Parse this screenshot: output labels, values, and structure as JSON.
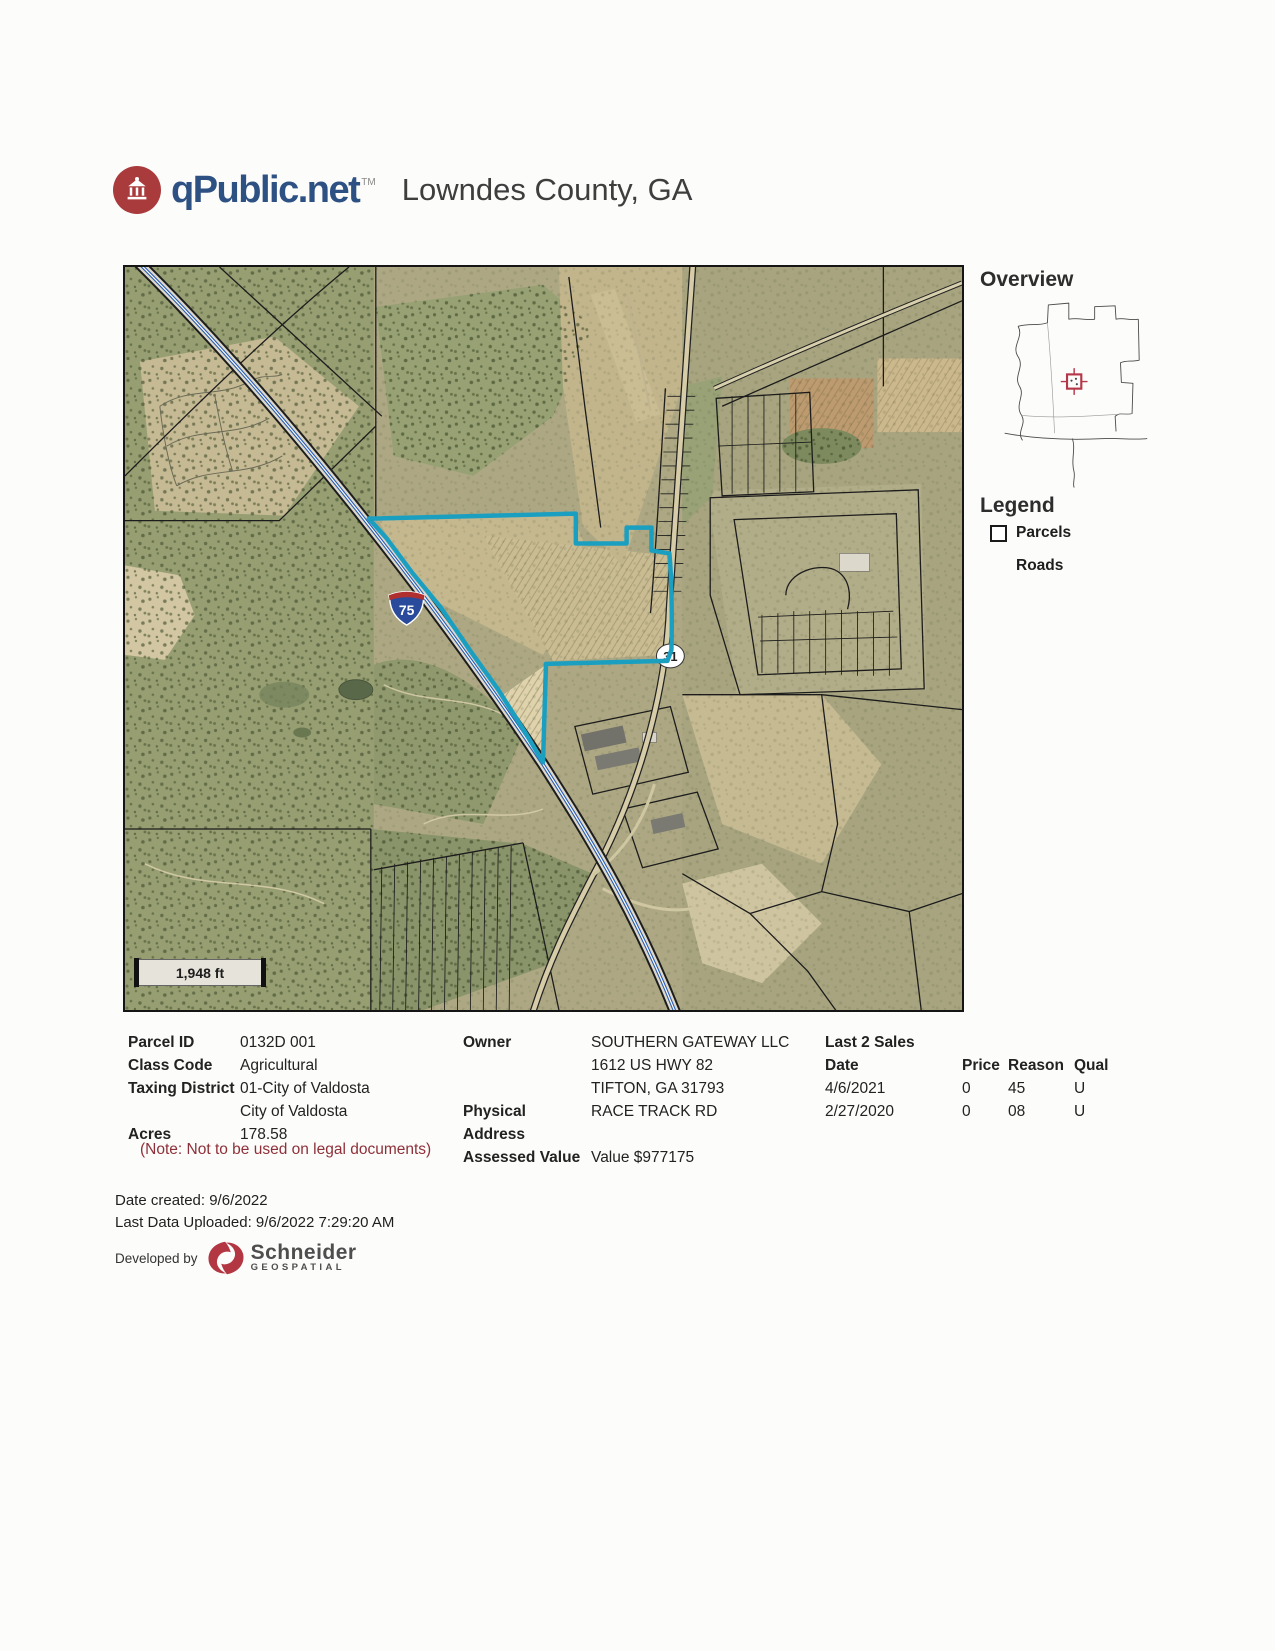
{
  "header": {
    "brand": "qPublic.net",
    "brand_tm": "TM",
    "title": "Lowndes County, GA"
  },
  "map": {
    "scale_label": "1,948 ft",
    "interstate_shield": "75",
    "route_shield": "31"
  },
  "sidebar": {
    "overview_title": "Overview",
    "legend_title": "Legend",
    "legend_items": [
      {
        "label": "Parcels",
        "icon": "parcel-square-icon"
      },
      {
        "label": "Roads",
        "icon": "road-line-icon"
      }
    ]
  },
  "details": {
    "left_rows": [
      {
        "label": "Parcel ID",
        "value": "0132D 001"
      },
      {
        "label": "Class Code",
        "value": "Agricultural"
      },
      {
        "label": "Taxing District",
        "value": "01-City of Valdosta"
      },
      {
        "label": "",
        "value": "City of Valdosta"
      },
      {
        "label": "Acres",
        "value": "178.58"
      }
    ],
    "note": "(Note: Not to be used on legal documents)",
    "middle_rows": [
      {
        "label": "Owner",
        "value": "SOUTHERN GATEWAY LLC"
      },
      {
        "label": "",
        "value": "1612 US HWY 82"
      },
      {
        "label": "",
        "value": "TIFTON, GA 31793"
      },
      {
        "label": "Physical Address",
        "value": "RACE TRACK RD"
      },
      {
        "label": "Assessed Value",
        "value": "Value $977175"
      }
    ],
    "sales": {
      "title": "Last 2 Sales",
      "headers": [
        "Date",
        "Price",
        "Reason",
        "Qual"
      ],
      "rows": [
        [
          "4/6/2021",
          "0",
          "45",
          "U"
        ],
        [
          "2/27/2020",
          "0",
          "08",
          "U"
        ]
      ]
    }
  },
  "footer": {
    "date_created": "Date created: 9/6/2022",
    "last_uploaded": "Last Data Uploaded: 9/6/2022 7:29:20 AM",
    "developed_by": "Developed by",
    "developer_name": "Schneider",
    "developer_sub": "GEOSPATIAL"
  },
  "colors": {
    "brand_blue": "#2e5184",
    "brand_red": "#a93b3d",
    "parcel_highlight": "#1b9fc0",
    "note_red": "#8e3039",
    "interstate_blue": "#2a4b9b",
    "interstate_red": "#b03030",
    "overview_marker_red": "#b5374a"
  }
}
